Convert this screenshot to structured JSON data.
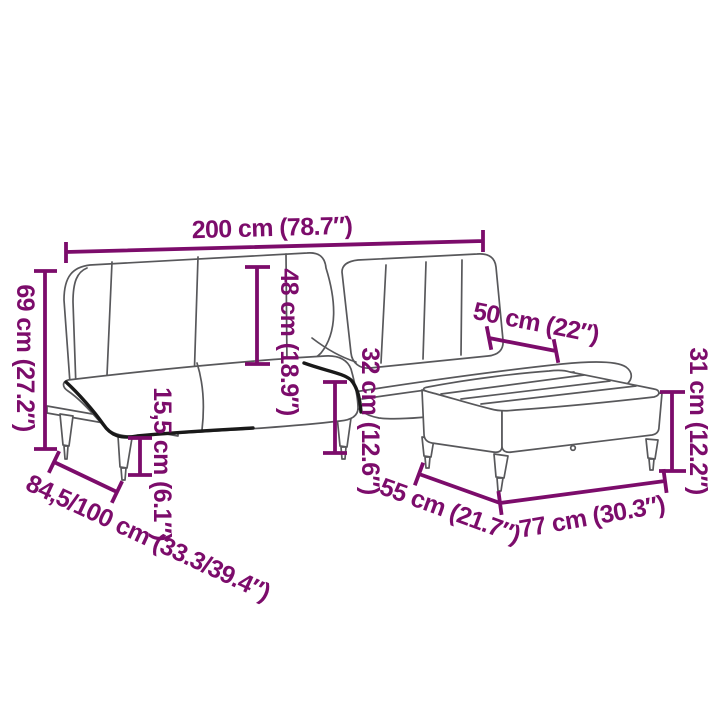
{
  "diagram": {
    "type": "product-dimension-diagram",
    "product": "sofa-bed-with-ottoman",
    "colors": {
      "background": "#ffffff",
      "line": "#58585b",
      "accent": "#191919",
      "dimension": "#7c0c6b"
    },
    "dimensions": {
      "sofa_width": "200 cm (78.7″)",
      "sofa_height": "69 cm (27.2″)",
      "backrest_height": "48 cm (18.9″)",
      "seat_height": "32 cm (12.6″)",
      "leg_height": "15,5 cm (6.1″)",
      "sofa_depth": "84,5/100 cm (33.3/39.4″)",
      "ottoman_back_width": "50 cm (22″)",
      "ottoman_height": "31 cm (12.2″)",
      "ottoman_depth": "55 cm (21.7″)",
      "ottoman_width": "77 cm (30.3″)"
    }
  }
}
